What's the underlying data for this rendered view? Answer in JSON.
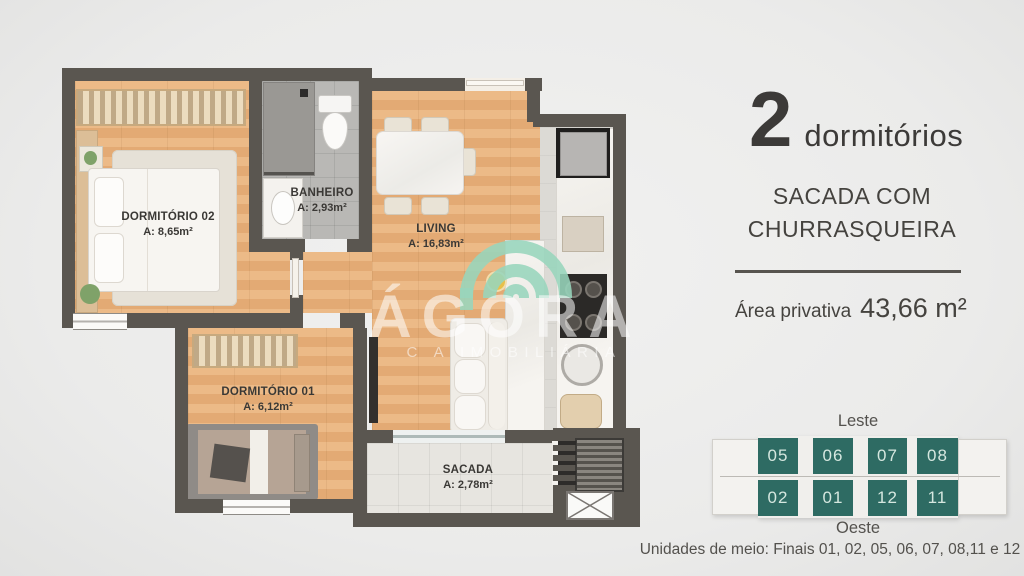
{
  "colors": {
    "background": "#ebebea",
    "wall": "#5a5650",
    "wood_floor": "#e7b07c",
    "unit_teal": "#2e6b63",
    "logo_green": "#98d5bc",
    "text_dark": "#3c3a38"
  },
  "floorplan": {
    "rooms": [
      {
        "name": "DORMITÓRIO 02",
        "area": "A: 8,65m²"
      },
      {
        "name": "BANHEIRO",
        "area": "A: 2,93m²"
      },
      {
        "name": "LIVING",
        "area": "A: 16,83m²"
      },
      {
        "name": "DORMITÓRIO 01",
        "area": "A: 6,12m²"
      },
      {
        "name": "SACADA",
        "area": "A: 2,78m²"
      }
    ],
    "watermark": {
      "brand": "ÁGORA",
      "subtitle": "C A IMOBILIÁRIA"
    }
  },
  "info_panel": {
    "bedrooms_count": "2",
    "bedrooms_label": "dormitórios",
    "feature_line1": "SACADA COM",
    "feature_line2": "CHURRASQUEIRA",
    "area_label": "Área privativa",
    "area_value": "43,66 m²"
  },
  "building_diagram": {
    "east_label": "Leste",
    "west_label": "Oeste",
    "top_units": [
      "05",
      "06",
      "07",
      "08"
    ],
    "bottom_units": [
      "02",
      "01",
      "12",
      "11"
    ],
    "caption": "Unidades de meio: Finais 01, 02, 05, 06, 07, 08,11 e 12"
  }
}
